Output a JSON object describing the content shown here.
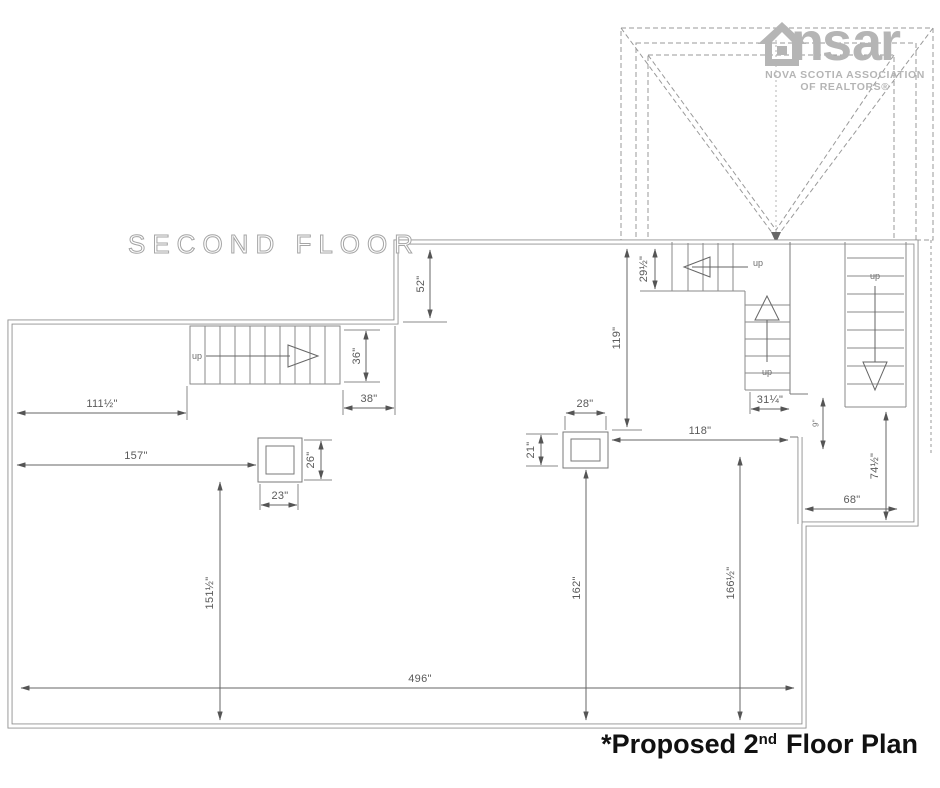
{
  "title_block": {
    "floor_label": "SECOND FLOOR"
  },
  "caption": {
    "prefix": "*Proposed 2",
    "sup": "nd",
    "suffix": "Floor Plan"
  },
  "logo": {
    "left": "ns",
    "right": "ar",
    "assoc_line1": "NOVA SCOTIA ASSOCIATION",
    "assoc_line2": "OF REALTORS®",
    "gray": "#b5b5b5"
  },
  "stairs": {
    "left_up": "up",
    "mid_horizontal_up": "up",
    "mid_vertical_up": "up",
    "right_up": "up"
  },
  "dims": {
    "d52": "52\"",
    "d36": "36\"",
    "d38": "38\"",
    "d111": "111½\"",
    "d157": "157\"",
    "d26": "26\"",
    "d23": "23\"",
    "d29": "29½\"",
    "d119": "119\"",
    "d28": "28\"",
    "d21": "21\"",
    "d118": "118\"",
    "d31": "31¼\"",
    "d9": "9\"",
    "d74": "74½\"",
    "d68": "68\"",
    "d151": "151½\"",
    "d162": "162\"",
    "d166": "166½\"",
    "d496": "496\""
  },
  "colors": {
    "wall": "#8f8f8f",
    "thin_line": "#7a7a7a",
    "dim_line": "#666666",
    "dim_text": "#5a5a5a",
    "roof_dash": "#9a9a9a",
    "caption_text": "#111111"
  }
}
